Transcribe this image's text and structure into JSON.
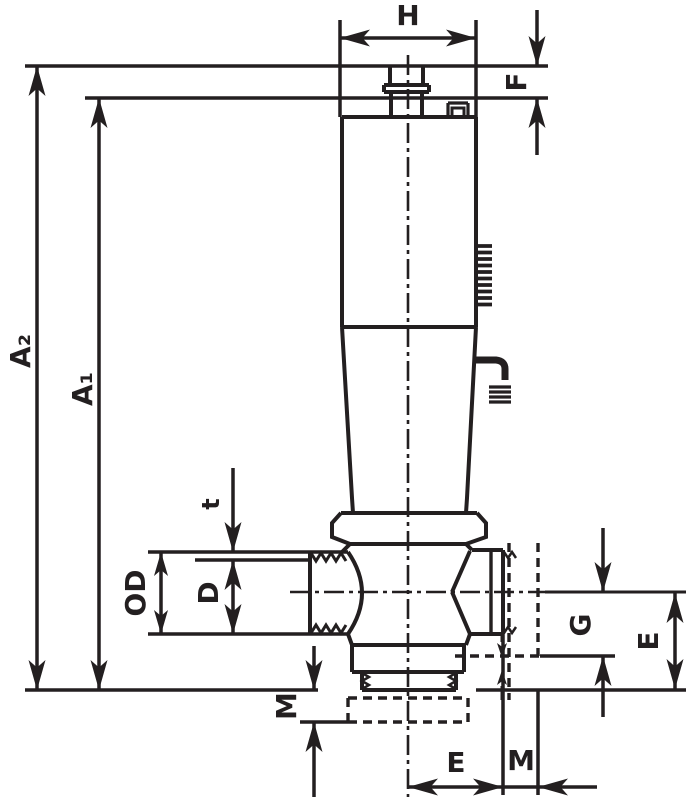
{
  "drawing": {
    "type": "technical-dimension-drawing",
    "subject": "valve-cross-section-with-dimension-callouts",
    "colors": {
      "line": "#231f20",
      "background": "#ffffff"
    },
    "dimensions": {
      "H": "H",
      "F": "F",
      "A2": "A₂",
      "A1": "A₁",
      "t": "t",
      "OD": "OD",
      "D": "D",
      "M_left": "M",
      "G": "G",
      "E_right": "E",
      "E_bottom": "E",
      "M_bottom": "M"
    }
  }
}
